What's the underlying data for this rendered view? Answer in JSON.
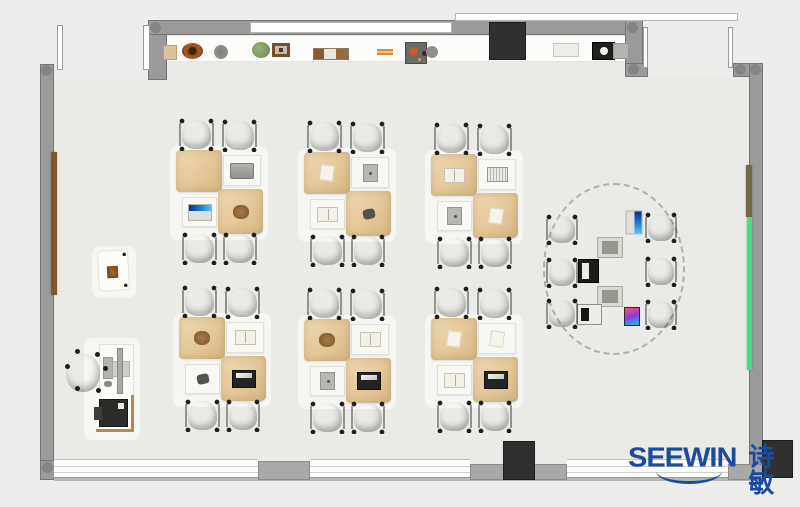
{
  "meta": {
    "title": "classroom furniture floor plan"
  },
  "logo": {
    "text_en": "SEEWIN",
    "text_cn": "诗敏",
    "color": "#1b4b9f"
  },
  "colors": {
    "background": "#ededec",
    "floor": "#eaeae7",
    "wall": "#9b9b9b",
    "chair_green": "#69903c",
    "chair_blue": "#5d8dbb",
    "office_chair_blue": "#5d8dbb",
    "desk_tan": "#e4c898",
    "desk_white": "#f8f8f5",
    "board_green": "#41e085",
    "board_olive": "#6f6b49",
    "board_wood_brown": "#7c5a2e",
    "column_dark": "#303030"
  },
  "floor": {
    "x": 54,
    "y": 33,
    "w": 709,
    "h": 445
  },
  "bg_patches": [
    {
      "x": 54,
      "y": 0,
      "w": 113,
      "h": 80
    },
    {
      "x": 637,
      "y": 0,
      "w": 163,
      "h": 77
    }
  ],
  "walls": [
    {
      "x": 40,
      "y": 64,
      "w": 14,
      "h": 416
    },
    {
      "x": 40,
      "y": 460,
      "w": 46,
      "h": 20
    },
    {
      "x": 148,
      "y": 20,
      "w": 19,
      "h": 60
    },
    {
      "x": 148,
      "y": 20,
      "w": 495,
      "h": 15
    },
    {
      "x": 625,
      "y": 20,
      "w": 18,
      "h": 57
    },
    {
      "x": 625,
      "y": 63,
      "w": 23,
      "h": 14
    },
    {
      "x": 733,
      "y": 63,
      "w": 30,
      "h": 14
    },
    {
      "x": 749,
      "y": 63,
      "w": 14,
      "h": 415
    }
  ],
  "corner_dots": [
    {
      "x": 41,
      "y": 65
    },
    {
      "x": 150,
      "y": 22
    },
    {
      "x": 627,
      "y": 22
    },
    {
      "x": 628,
      "y": 64
    },
    {
      "x": 735,
      "y": 64
    },
    {
      "x": 750,
      "y": 64
    },
    {
      "x": 42,
      "y": 462
    },
    {
      "x": 750,
      "y": 463
    }
  ],
  "windows_top": [
    {
      "x": 250,
      "y": 22,
      "w": 202,
      "h": 11
    },
    {
      "x": 455,
      "y": 13,
      "w": 283,
      "h": 8
    }
  ],
  "counter": {
    "x": 163,
    "y": 35,
    "w": 467,
    "h": 27
  },
  "columns": [
    {
      "x": 489,
      "y": 22,
      "w": 37,
      "h": 38
    },
    {
      "x": 503,
      "y": 441,
      "w": 32,
      "h": 39
    },
    {
      "x": 762,
      "y": 440,
      "w": 31,
      "h": 38
    }
  ],
  "baseline": {
    "x": 54,
    "y": 477,
    "w": 710,
    "h": 4
  },
  "windows_bottom": [
    {
      "x": 54,
      "y": 459,
      "w": 204,
      "h": 19
    },
    {
      "x": 310,
      "y": 459,
      "w": 160,
      "h": 19
    },
    {
      "x": 567,
      "y": 459,
      "w": 163,
      "h": 19
    }
  ],
  "gray_segments": [
    {
      "x": 258,
      "y": 461,
      "w": 52,
      "h": 19
    },
    {
      "x": 470,
      "y": 464,
      "w": 97,
      "h": 16
    },
    {
      "x": 728,
      "y": 464,
      "w": 35,
      "h": 16
    }
  ],
  "door_leaves": [
    {
      "x": 57,
      "y": 25,
      "w": 6,
      "h": 45
    },
    {
      "x": 143,
      "y": 25,
      "w": 7,
      "h": 45
    },
    {
      "x": 643,
      "y": 27,
      "w": 5,
      "h": 41
    },
    {
      "x": 728,
      "y": 27,
      "w": 5,
      "h": 41
    }
  ],
  "boards": [
    {
      "name": "wood-strip-left-wall",
      "x": 51,
      "y": 152,
      "w": 6,
      "h": 143,
      "color": "#7c5a2e"
    },
    {
      "name": "olive-board-right-wall",
      "x": 746,
      "y": 165,
      "w": 6,
      "h": 52,
      "color": "#6f6b49"
    },
    {
      "name": "green-board-right-wall",
      "x": 747,
      "y": 217,
      "w": 5,
      "h": 153,
      "color": "#41e085"
    }
  ],
  "shelf_items": [
    {
      "type": "box-tan",
      "x": 163,
      "y": 45,
      "w": 12,
      "h": 13
    },
    {
      "type": "basket-brown",
      "x": 182,
      "y": 43,
      "w": 21,
      "h": 16
    },
    {
      "type": "pot-gray",
      "x": 214,
      "y": 45,
      "w": 14,
      "h": 14
    },
    {
      "type": "plant-green",
      "x": 252,
      "y": 42,
      "w": 18,
      "h": 16
    },
    {
      "type": "frame-photo",
      "x": 272,
      "y": 43,
      "w": 18,
      "h": 14
    },
    {
      "type": "books-row",
      "x": 313,
      "y": 48,
      "w": 34,
      "h": 10
    },
    {
      "type": "sticks-orange",
      "x": 377,
      "y": 49,
      "w": 16,
      "h": 6
    },
    {
      "type": "tray-clutter",
      "x": 405,
      "y": 42,
      "w": 20,
      "h": 20
    },
    {
      "type": "box-white",
      "x": 553,
      "y": 43,
      "w": 24,
      "h": 12
    },
    {
      "type": "machine-dark",
      "x": 592,
      "y": 42,
      "w": 21,
      "h": 16
    },
    {
      "type": "box-gray",
      "x": 613,
      "y": 43,
      "w": 14,
      "h": 14
    }
  ],
  "pod_template": {
    "mat": {
      "dx": -8,
      "dy": 28,
      "w": 98,
      "h": 94
    },
    "chairs": [
      {
        "dx": 0,
        "dy": 0,
        "w": 37,
        "h": 33,
        "color": "green"
      },
      {
        "dx": 43,
        "dy": 1,
        "w": 37,
        "h": 33,
        "color": "blue"
      },
      {
        "dx": 3,
        "dy": 114,
        "w": 37,
        "h": 33,
        "color": "blue"
      },
      {
        "dx": 44,
        "dy": 114,
        "w": 36,
        "h": 33,
        "color": "green"
      }
    ],
    "desks": [
      {
        "dx": -2,
        "dy": 32,
        "w": 46,
        "h": 42,
        "kind": "tan"
      },
      {
        "dx": 45,
        "dy": 37,
        "w": 38,
        "h": 31,
        "kind": "white"
      },
      {
        "dx": 4,
        "dy": 79,
        "w": 35,
        "h": 30,
        "kind": "white"
      },
      {
        "dx": 40,
        "dy": 71,
        "w": 45,
        "h": 45,
        "kind": "tan"
      }
    ]
  },
  "pods": [
    {
      "x": 178,
      "y": 118,
      "items": [
        null,
        "laptop-gray",
        "laptop-open",
        "bag-brown"
      ]
    },
    {
      "x": 306,
      "y": 120,
      "items": [
        "paper",
        "tablet-gray",
        "book-open",
        "pouch-dark"
      ]
    },
    {
      "x": 433,
      "y": 122,
      "items": [
        "book-open",
        "notebook-lines",
        "tablet-gray",
        "paper"
      ]
    },
    {
      "x": 181,
      "y": 285,
      "items": [
        "bag-brown",
        "book-open",
        "pouch-dark",
        "laptop-dark"
      ]
    },
    {
      "x": 306,
      "y": 287,
      "items": [
        "bag-brown",
        "book-open",
        "tablet-gray",
        "laptop-dark"
      ]
    },
    {
      "x": 433,
      "y": 286,
      "items": [
        "paper",
        "paper",
        "book-open",
        "laptop-dark"
      ]
    }
  ],
  "collab": {
    "ellipse": {
      "x": 543,
      "y": 183,
      "w": 142,
      "h": 172
    },
    "chairs": [
      {
        "x": 545,
        "y": 214,
        "w": 34,
        "h": 31
      },
      {
        "x": 644,
        "y": 212,
        "w": 34,
        "h": 31
      },
      {
        "x": 545,
        "y": 257,
        "w": 34,
        "h": 31
      },
      {
        "x": 644,
        "y": 256,
        "w": 34,
        "h": 31
      },
      {
        "x": 545,
        "y": 298,
        "w": 34,
        "h": 31
      },
      {
        "x": 644,
        "y": 299,
        "w": 34,
        "h": 31
      }
    ],
    "devices": [
      {
        "type": "laptop-open",
        "x": 622,
        "y": 214,
        "rot": 90
      },
      {
        "type": "monitor-gray",
        "x": 597,
        "y": 237,
        "rot": 0
      },
      {
        "type": "laptop-black",
        "x": 578,
        "y": 259,
        "rot": 0
      },
      {
        "type": "monitor-gray",
        "x": 597,
        "y": 286,
        "rot": 0
      },
      {
        "type": "laptop-small",
        "x": 577,
        "y": 304,
        "rot": 0
      },
      {
        "type": "tablet-colorful",
        "x": 624,
        "y": 307,
        "rot": 0
      }
    ]
  },
  "teacher": {
    "mats": [
      {
        "x": 92,
        "y": 246,
        "w": 44,
        "h": 52
      },
      {
        "x": 84,
        "y": 338,
        "w": 56,
        "h": 102
      }
    ],
    "lectern": {
      "x": 98,
      "y": 250,
      "w": 31,
      "h": 41
    },
    "desk": {
      "x": 99,
      "y": 344,
      "w": 35,
      "h": 55
    },
    "monitor": {
      "x": 117,
      "y": 348,
      "w": 6,
      "h": 46
    },
    "monitor_base": {
      "x": 112,
      "y": 361,
      "w": 18,
      "h": 16
    },
    "keyboard": {
      "x": 103,
      "y": 357,
      "w": 10,
      "h": 22
    },
    "mouse": {
      "x": 104,
      "y": 381,
      "w": 8,
      "h": 6
    },
    "office_chair": {
      "x": 63,
      "y": 350,
      "w": 40,
      "h": 46
    },
    "printer_stand": {
      "x": 96,
      "y": 395,
      "w": 38,
      "h": 37
    },
    "printer": {
      "x": 99,
      "y": 399,
      "w": 29,
      "h": 28
    }
  }
}
